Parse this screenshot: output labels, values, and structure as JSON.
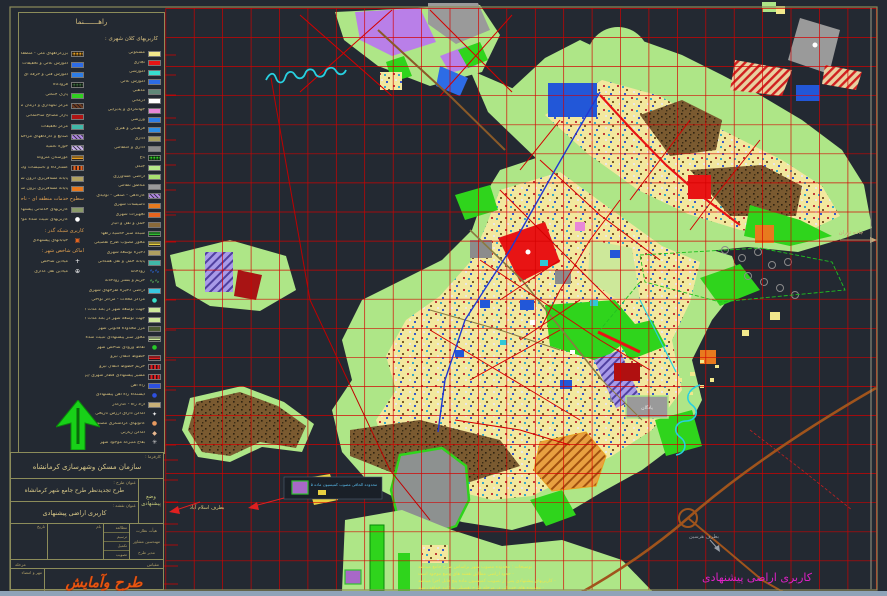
{
  "window": {
    "canvas_bg": "#232932",
    "frame_color": "#8c8c5a",
    "grid_color": "#d40000"
  },
  "legend": {
    "title": "راهـــــــنما",
    "subtitle": "کاربریهای کلان شهری :",
    "col_right": [
      {
        "label": "مسکونی",
        "color": "#f2e88c"
      },
      {
        "label": "تجاری",
        "color": "#e81414"
      },
      {
        "label": "آموزشی",
        "color": "#38e0d0"
      },
      {
        "label": "آموزش عالی",
        "color": "#2d6ce6"
      },
      {
        "label": "مذهبی",
        "color": "#5f8878"
      },
      {
        "label": "درمانی",
        "color": "#ffffff"
      },
      {
        "label": "جهانگردی و پذیرایی",
        "color": "#e887d8"
      },
      {
        "label": "ورزشی",
        "color": "#2d7de6"
      },
      {
        "label": "فرهنگی و هنری",
        "color": "#2d8ee6"
      },
      {
        "label": "اداری",
        "color": "#a8a060"
      },
      {
        "label": "اداری و انتظامی",
        "color": "#8c8c8c"
      },
      {
        "label": "باغ",
        "color": "#30d020",
        "pattern": "checker"
      },
      {
        "label": "جنگل",
        "color": "#b8e88a"
      },
      {
        "label": "اراضی کشاورزی",
        "color": "#a8e070"
      },
      {
        "label": "مناطق نظامی",
        "color": "#9a9a9a"
      },
      {
        "label": "کارگاهی - صنفی - تولیدی",
        "color": "#b088e0",
        "pattern": "hatch"
      },
      {
        "label": "تاسیسات شهری",
        "color": "#e87a1e"
      },
      {
        "label": "تجهیزات شهری",
        "color": "#e8641e"
      },
      {
        "label": "حمل و نقل و انبار",
        "color": "#8a6a3a"
      },
      {
        "label": "شبکه سبز حاشیه راهها",
        "color": "#30c030",
        "pattern": "hbars"
      },
      {
        "label": "محور مصوب طرح تفصیلی",
        "color": "#e8d040",
        "pattern": "hbars"
      },
      {
        "label": "ذخیره توسعه شهری",
        "color": "#b0a060"
      },
      {
        "label": "پایانه حمل و نقل همگانی",
        "color": "#40b8a8"
      },
      {
        "label": "رودخانه",
        "color": "#2d6ce6",
        "pattern": "wave"
      },
      {
        "label": "حریم و بستر رودخانه",
        "color": "#60c860",
        "pattern": "wave"
      },
      {
        "label": "اراضی ذخیره طرحهای شهری",
        "color": "#38c8e0"
      },
      {
        "label": "مراکز محلات - مراکز نواحی",
        "color": "#38e0c8",
        "symbol": "dot"
      },
      {
        "label": "جهت توسعه شهر در بلند مدت (احتمالی - اصلاحی)",
        "color": "#cde89a"
      },
      {
        "label": "جهت توسعه شهر در بلند مدت (احتمالی)",
        "color": "#cde89a"
      },
      {
        "label": "مرز محدوده قانونی شهر",
        "color": "#4a5a30"
      },
      {
        "label": "محور سبز پیشنهادی تثبیت شده",
        "color": "#cde89a",
        "pattern": "hbars"
      },
      {
        "label": "نقاط ورودی شاخص شهر",
        "color": "#28c828",
        "symbol": "dot"
      },
      {
        "label": "خطوط انتقال نیرو",
        "color": "#e02020",
        "pattern": "hbars"
      },
      {
        "label": "حریم خطوط انتقال نیرو",
        "color": "#e02020",
        "pattern": "vbars"
      },
      {
        "label": "مسیر پیشنهادی قطار شهری (پروژه)",
        "color": "#e02020",
        "pattern": "vbars"
      },
      {
        "label": "راه آهن",
        "color": "#2d50e0"
      },
      {
        "label": "ایستگاه راه آهن پیشنهادی",
        "color": "#2d50e0",
        "symbol": "dot"
      },
      {
        "label": "آزاد راه - کنارگذر",
        "color": "#c8b078"
      },
      {
        "label": "اماکن دارای ارزش تاریخی",
        "color": "#e8e8e8",
        "symbol": "star"
      },
      {
        "label": "کانونهای گردشگری مصنوع",
        "color": "#e89a60",
        "symbol": "blob"
      },
      {
        "label": "اماکن زیارتی",
        "color": "#e8b890",
        "symbol": "diamond"
      },
      {
        "label": "بقاع متبرکه موجود شهر",
        "color": "#c8c8c8",
        "symbol": "asterisk"
      }
    ],
    "col_left": [
      {
        "label": "بزرگراههای ملی - منطقه ای",
        "color": "#e8a020",
        "pattern": "checker"
      },
      {
        "label": "آموزش عالی و تحقیقات",
        "color": "#2d6ce6"
      },
      {
        "label": "آموزش فنی و حرفه ای",
        "color": "#2d7de6"
      },
      {
        "label": "فرودگاه",
        "color": "#3a6a3a",
        "pattern": "checker"
      },
      {
        "label": "پارک جنگلی",
        "color": "#30d020"
      },
      {
        "label": "مرکز نگهداری و درمان معتادان",
        "color": "#6a3a20",
        "pattern": "hatch"
      },
      {
        "label": "بازار مصالح ساختمانی",
        "color": "#b01414"
      },
      {
        "label": "مرکز تحقیقات",
        "color": "#40b8a8"
      },
      {
        "label": "صنایع و کارگاههای مزاحم شهری",
        "color": "#b088e0",
        "pattern": "hatch"
      },
      {
        "label": "حوزه علمیه",
        "color": "#c8b0e8",
        "pattern": "hatch"
      },
      {
        "label": "گورستان متروکه",
        "color": "#e8a020",
        "pattern": "hbars"
      },
      {
        "label": "کشتارگاه و تاسیسات وابسته",
        "color": "#e8641e",
        "pattern": "vbars"
      },
      {
        "label": "پایانه مسافربری درون شهری",
        "color": "#b0a060"
      },
      {
        "label": "پایانه مسافربری برون شهری",
        "color": "#e87a1e"
      },
      {
        "header": "سطوح خدمات منطقه ای - ناحیه ای :"
      },
      {
        "label": "کاربریهای خدماتی پیشنهادی مقیاس شهری",
        "color": "#8a9a6a"
      },
      {
        "label": "کاربریهای تثبیت شده موجود",
        "color": "#ffffff",
        "symbol": "dot"
      },
      {
        "header": "کاربری شبکه گذر :"
      },
      {
        "label": "خیابانهای پیشنهادی",
        "color": "#e8641e",
        "symbol": "boxdot"
      },
      {
        "header": "اماکن شاخص شهر :"
      },
      {
        "label": "میادین شاخص",
        "color": "#ffffff",
        "symbol": "plus"
      },
      {
        "label": "میادین ثقل گذاری",
        "color": "#ffffff",
        "symbol": "target"
      }
    ]
  },
  "titleblock": {
    "client_label": "کارفرما :",
    "client": "سازمان مسکن وشهرسازی کرمانشاه",
    "plan_label": "عنوان طرح :",
    "plan": "طرح تجدیدنظر طرح جامع شهر کرمانشاه",
    "sheet_label": "عنوان نقشه :",
    "sheet": "کاربری اراضی پیشنهادی",
    "side_tab_1": "وضع",
    "side_tab_2": "پیشنهادی",
    "table": {
      "col_date": "تاریخ",
      "col_name": "نام",
      "rows": [
        "مطالعه",
        "ترسیم",
        "تکمیل",
        "تصویب"
      ],
      "board": "هیأت نظارت",
      "supervisor": "مهندسین مشاور",
      "manager": "مدیر طرح",
      "scale_label": "مقیاس",
      "stage_label": "مرحله"
    },
    "seal_label": "مهر و امضاء",
    "logo": "طرح وآمایش",
    "logo_color": "#e85510"
  },
  "map": {
    "bottom_title": "کاربری اراضی پیشنهادی",
    "bottom_title_color": "#e020c8",
    "labels": {
      "road_tehran": "جاده تهران",
      "road_islamabad": "بطرف اسلام آباد",
      "road_harsin": "بطرف هرسین",
      "garrison": "پادگان",
      "callout": "محدوده الحاقی مصوب کمیسیون ماده ۵"
    },
    "notes": [
      "توضیحات : محدوده مصوب شهر براساس طرح جامع میباشد",
      "- حدود اراضی مطابق نقشه های وضع موجود است",
      "- کاربریهای پیشنهادی پس از تصویب کمیسیون ماده پنج قابل اجرا میباشد",
      "- محدوده های خدماتی در مرحله طرح تفصیلی به تایید خواهد رسید"
    ],
    "north_arrow_color": "#18d018"
  }
}
